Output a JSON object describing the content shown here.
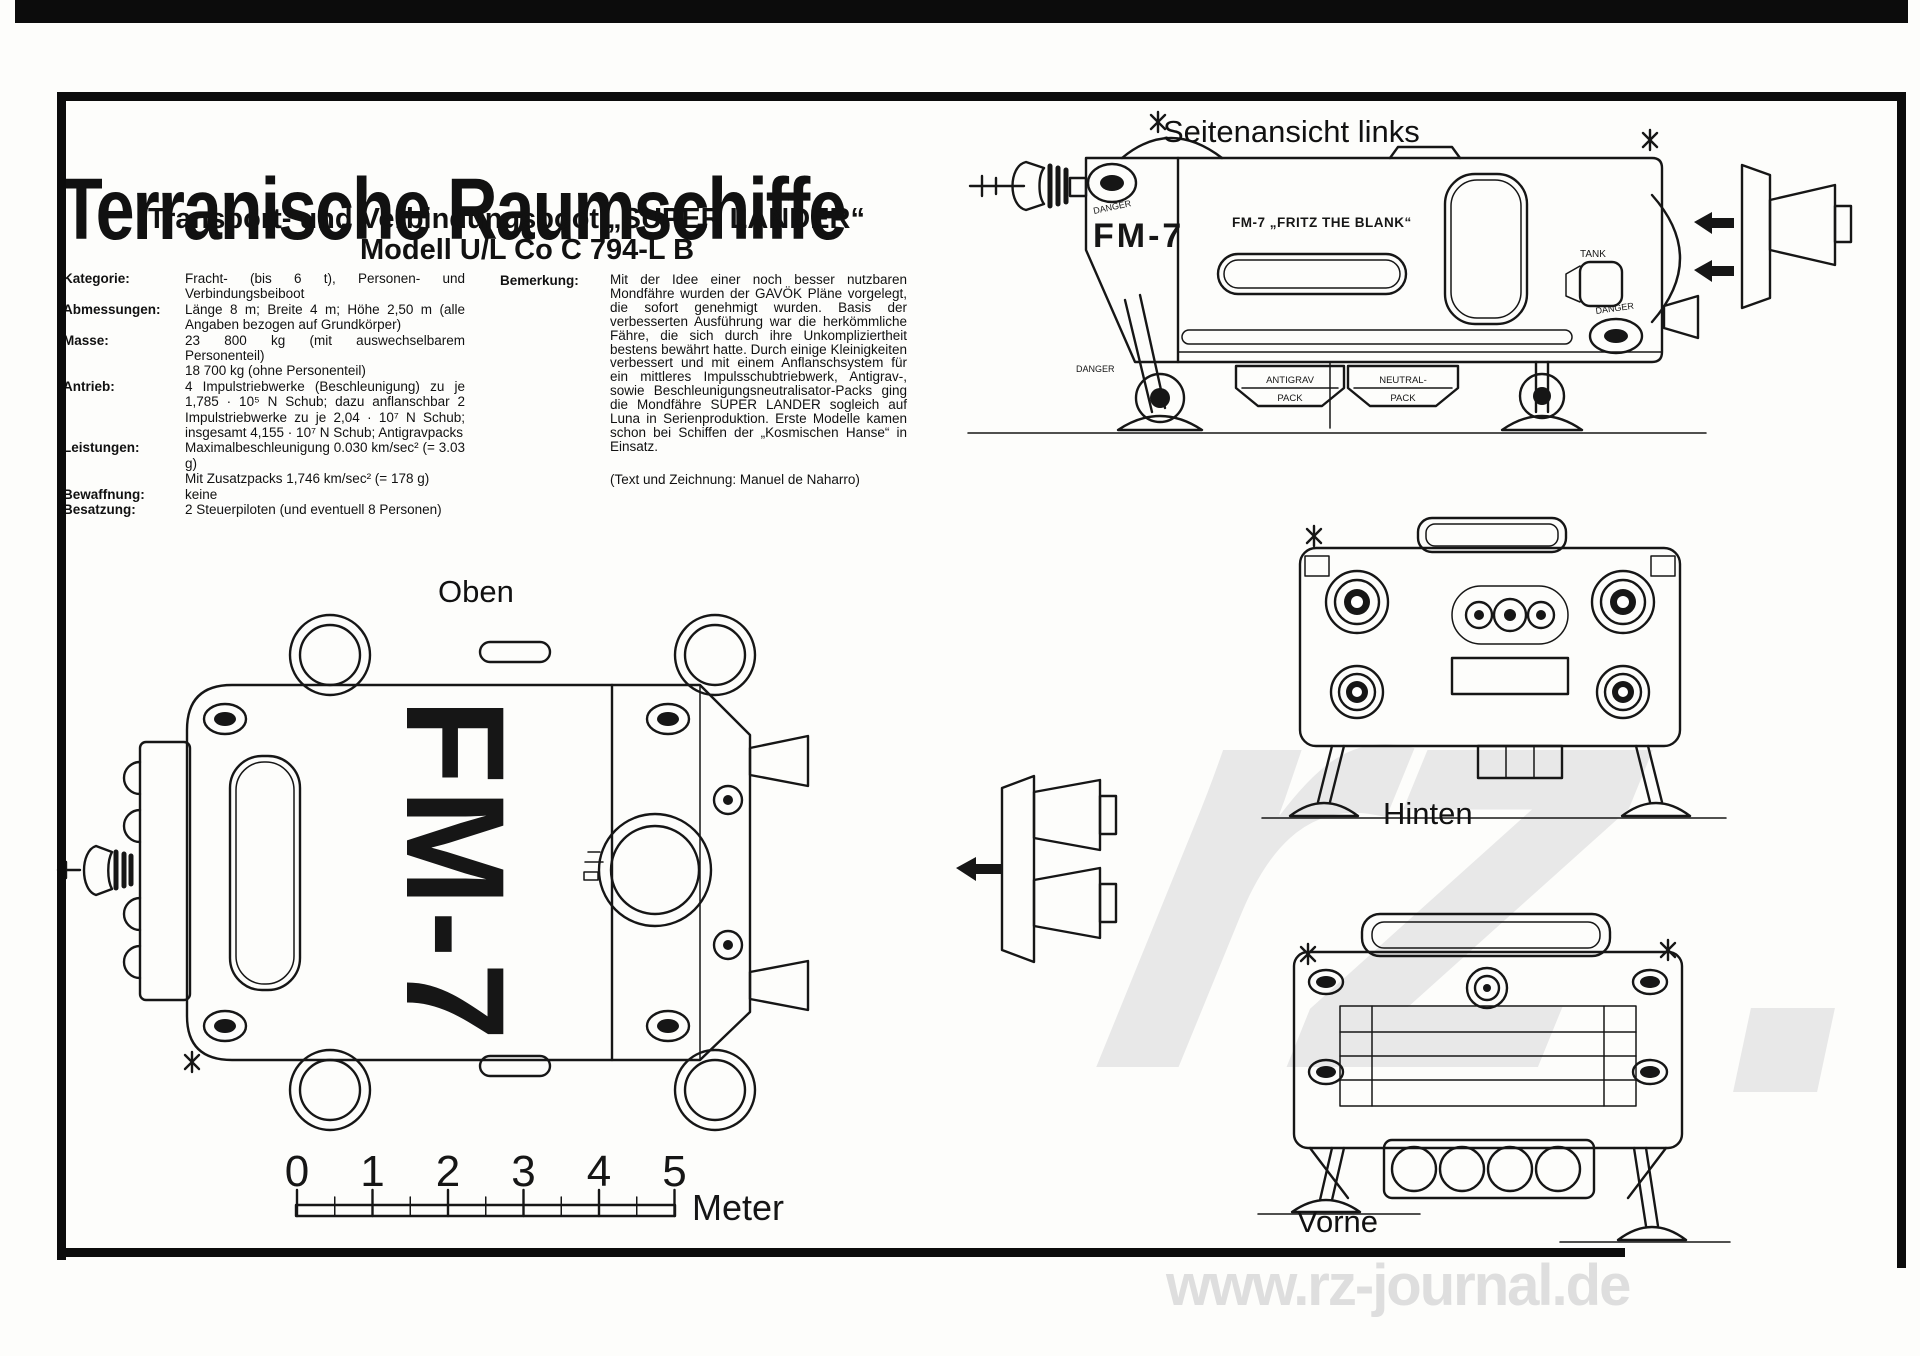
{
  "header": {
    "title": "Terranische Raumschiffe",
    "subtitle": "Transport- und Verbindungsboot „SUPER LANDER“",
    "model_line": "Modell U/L Co C 794-L B"
  },
  "specs": {
    "rows": [
      {
        "label": "Kategorie:",
        "value": "Fracht- (bis 6 t), Personen- und Verbindungsbeiboot"
      },
      {
        "label": "Abmessungen:",
        "value": "Länge 8 m; Breite 4 m; Höhe 2,50 m (alle Angaben bezogen auf Grundkörper)"
      },
      {
        "label": "Masse:",
        "value": "23 800 kg (mit auswechselbarem Personenteil)\n18 700 kg (ohne Personenteil)"
      },
      {
        "label": "Antrieb:",
        "value": "4 Impulstriebwerke (Beschleunigung) zu je 1,785 · 10⁵ N Schub; dazu anflanschbar 2 Impulstriebwerke zu je 2,04 · 10⁷ N Schub; insgesamt 4,155 · 10⁷ N Schub; Antigravpacks"
      },
      {
        "label": "Leistungen:",
        "value": "Maximalbeschleunigung 0.030 km/sec² (= 3.03 g)\nMit Zusatzpacks 1,746 km/sec² (= 178 g)"
      },
      {
        "label": "Bewaffnung:",
        "value": "keine"
      },
      {
        "label": "Besatzung:",
        "value": "2 Steuerpiloten (und eventuell 8 Personen)"
      }
    ]
  },
  "remark": {
    "label": "Bemerkung:",
    "text": "Mit der Idee einer noch besser nutzbaren Mondfähre wurden der GAVÖK Pläne vorgelegt, die sofort genehmigt wurden. Basis der verbesserten Ausführung war die herkömmliche Fähre, die sich durch ihre Unkompliziertheit bestens bewährt hatte. Durch einige Kleinigkeiten verbessert und mit einem Anflanschsystem für ein mittleres Impulsschubtriebwerk, Antigrav-, sowie Beschleunigungsneutralisator-Packs ging die Mondfähre SUPER LANDER sogleich auf Luna in Serienproduktion. Erste Modelle kamen schon bei Schiffen der „Kosmischen Hanse“ in Einsatz.",
    "credit": "(Text und Zeichnung: Manuel de Naharro)"
  },
  "views": {
    "side": {
      "title": "Seitenansicht links",
      "code_large": "FM-7",
      "name_plate": "FM-7  „FRITZ THE BLANK“",
      "tank": "TANK",
      "danger": "DANGER",
      "box1_top": "ANTIGRAV",
      "box1_bottom": "PACK",
      "box2_top": "NEUTRAL-",
      "box2_bottom": "PACK"
    },
    "top": {
      "title": "Oben",
      "code": "FM-7"
    },
    "rear": {
      "title": "Hinten"
    },
    "front": {
      "title": "Vorne"
    }
  },
  "scale_bar": {
    "ticks": [
      "0",
      "1",
      "2",
      "3",
      "4",
      "5"
    ],
    "unit": "Meter"
  },
  "watermark": {
    "logo": "rz",
    "url": "www.rz-journal.de"
  },
  "colors": {
    "ink": "#161616",
    "paper": "#fdfdfb",
    "watermark_gray": "#e8e8e8"
  }
}
